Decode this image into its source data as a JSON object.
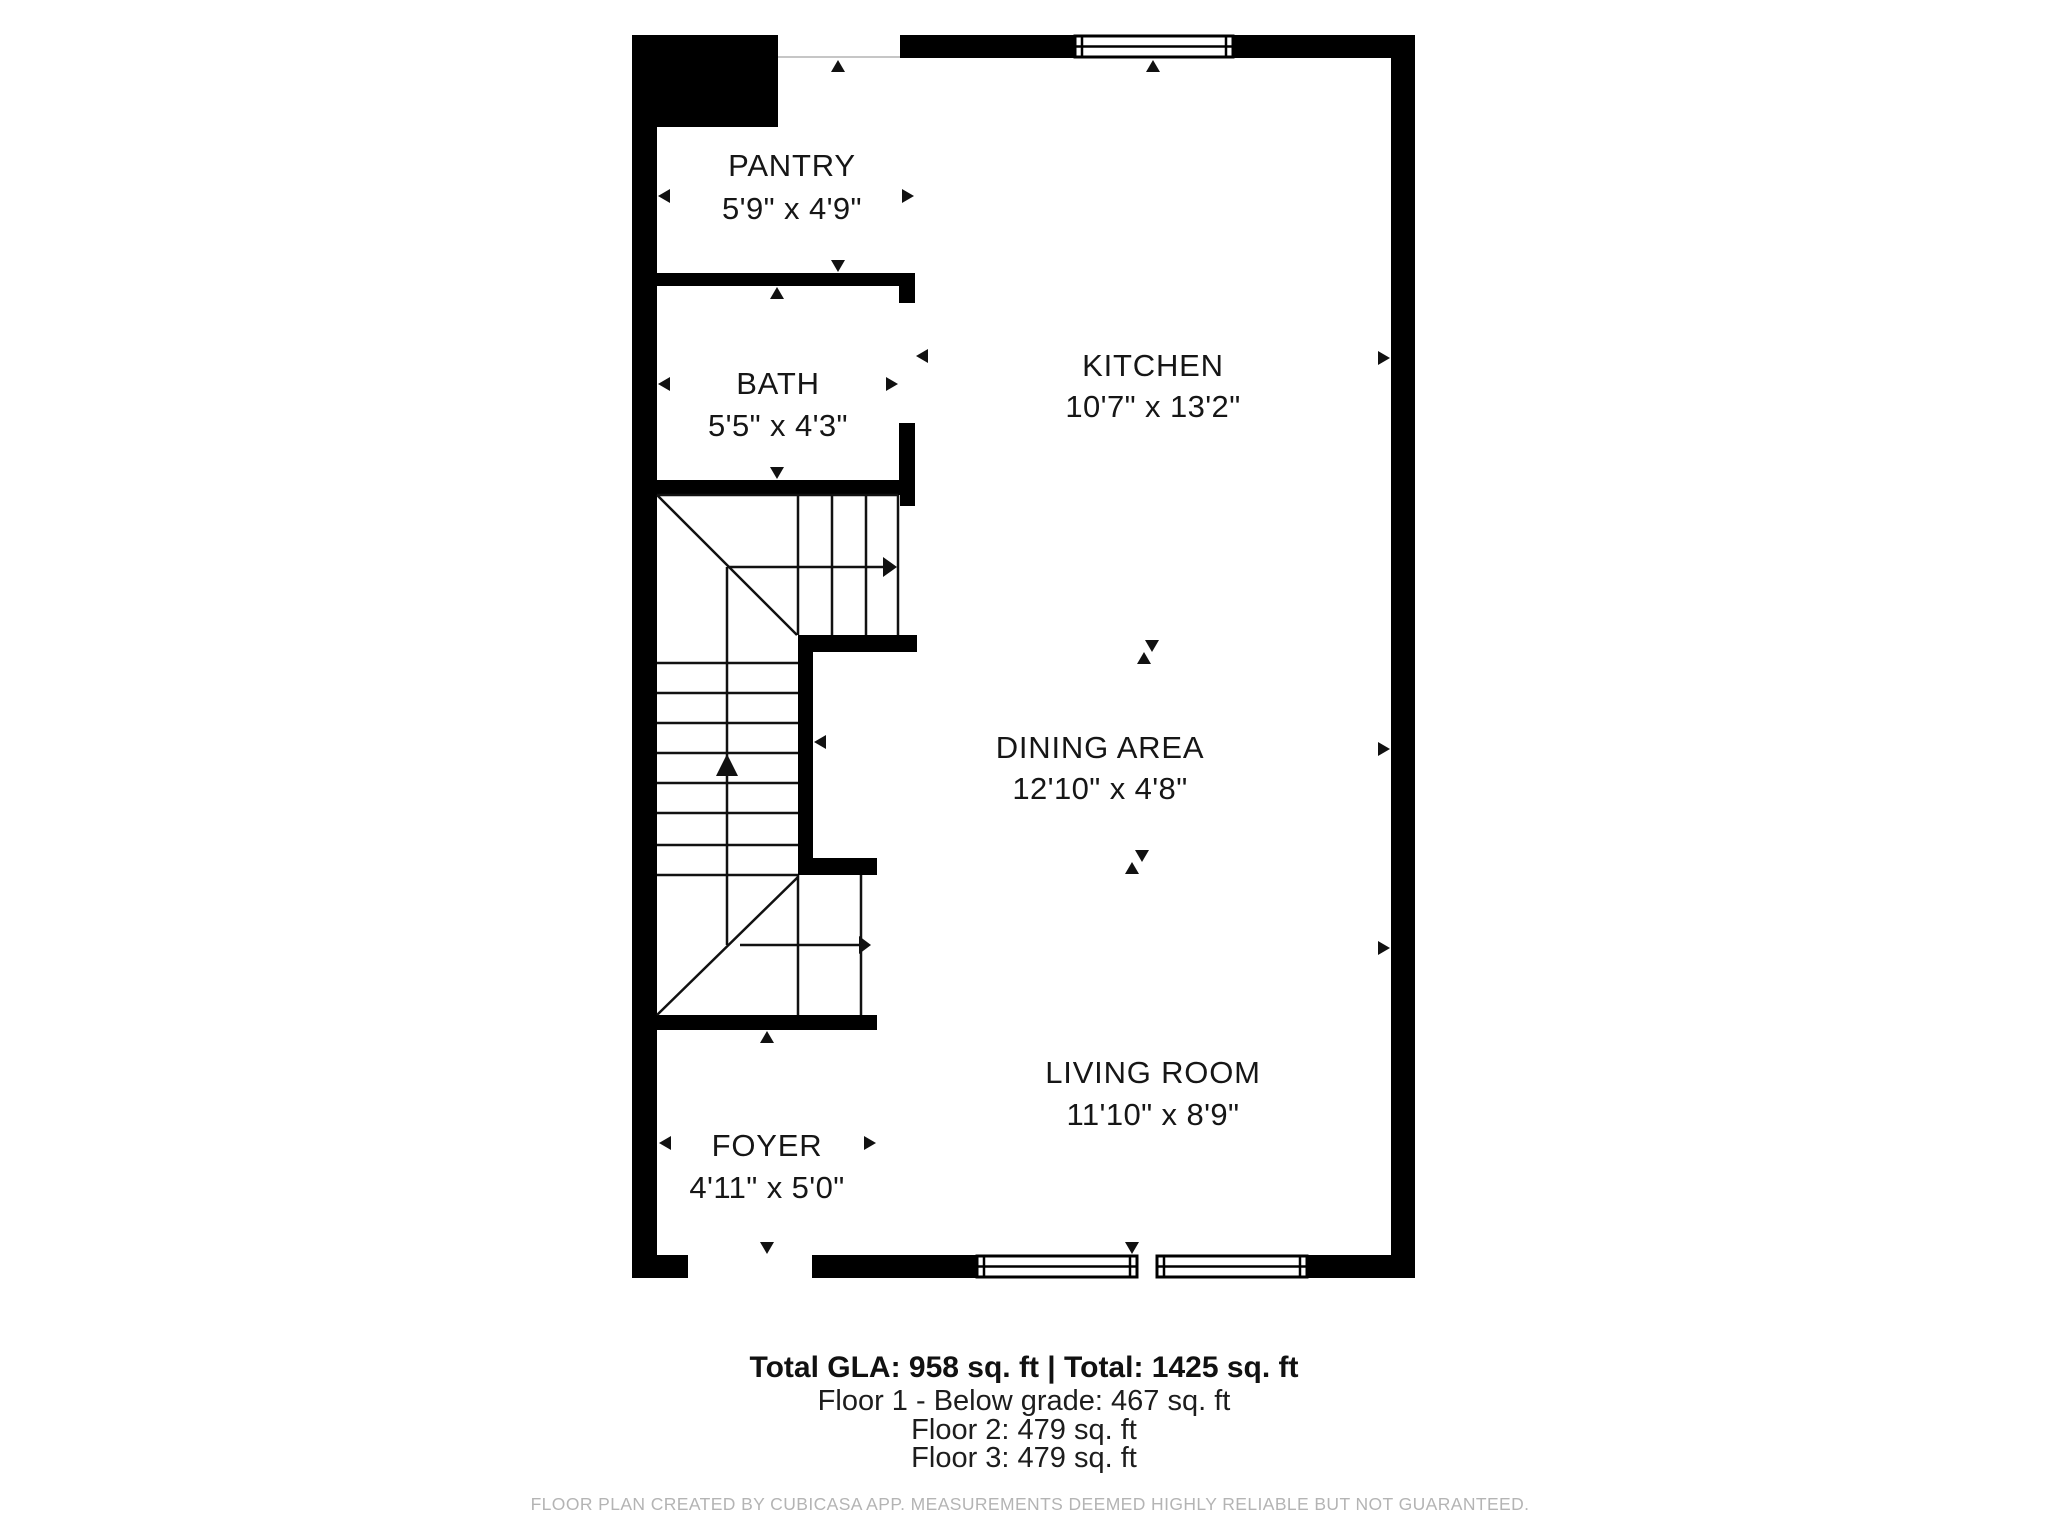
{
  "rooms": [
    {
      "name": "PANTRY",
      "dims": "5'9\" x 4'9\""
    },
    {
      "name": "BATH",
      "dims": "5'5\" x 4'3\""
    },
    {
      "name": "KITCHEN",
      "dims": "10'7\" x 13'2\""
    },
    {
      "name": "DINING AREA",
      "dims": "12'10\" x 4'8\""
    },
    {
      "name": "LIVING ROOM",
      "dims": "11'10\" x 8'9\""
    },
    {
      "name": "FOYER",
      "dims": "4'11\" x 5'0\""
    }
  ],
  "summary": {
    "total_line": "Total GLA: 958 sq. ft | Total: 1425 sq. ft",
    "floors": [
      "Floor 1 - Below grade: 467 sq. ft",
      "Floor 2: 479 sq. ft",
      "Floor 3: 479 sq. ft"
    ]
  },
  "footer": {
    "disclaimer": "FLOOR PLAN CREATED BY CUBICASA APP. MEASUREMENTS DEEMED HIGHLY RELIABLE BUT NOT GUARANTEED."
  },
  "colors": {
    "wall": "#000000",
    "room_text": "#161616",
    "footer_text": "#b4b4b4",
    "background": "#ffffff",
    "open_boundary": "#c6c6c6"
  }
}
